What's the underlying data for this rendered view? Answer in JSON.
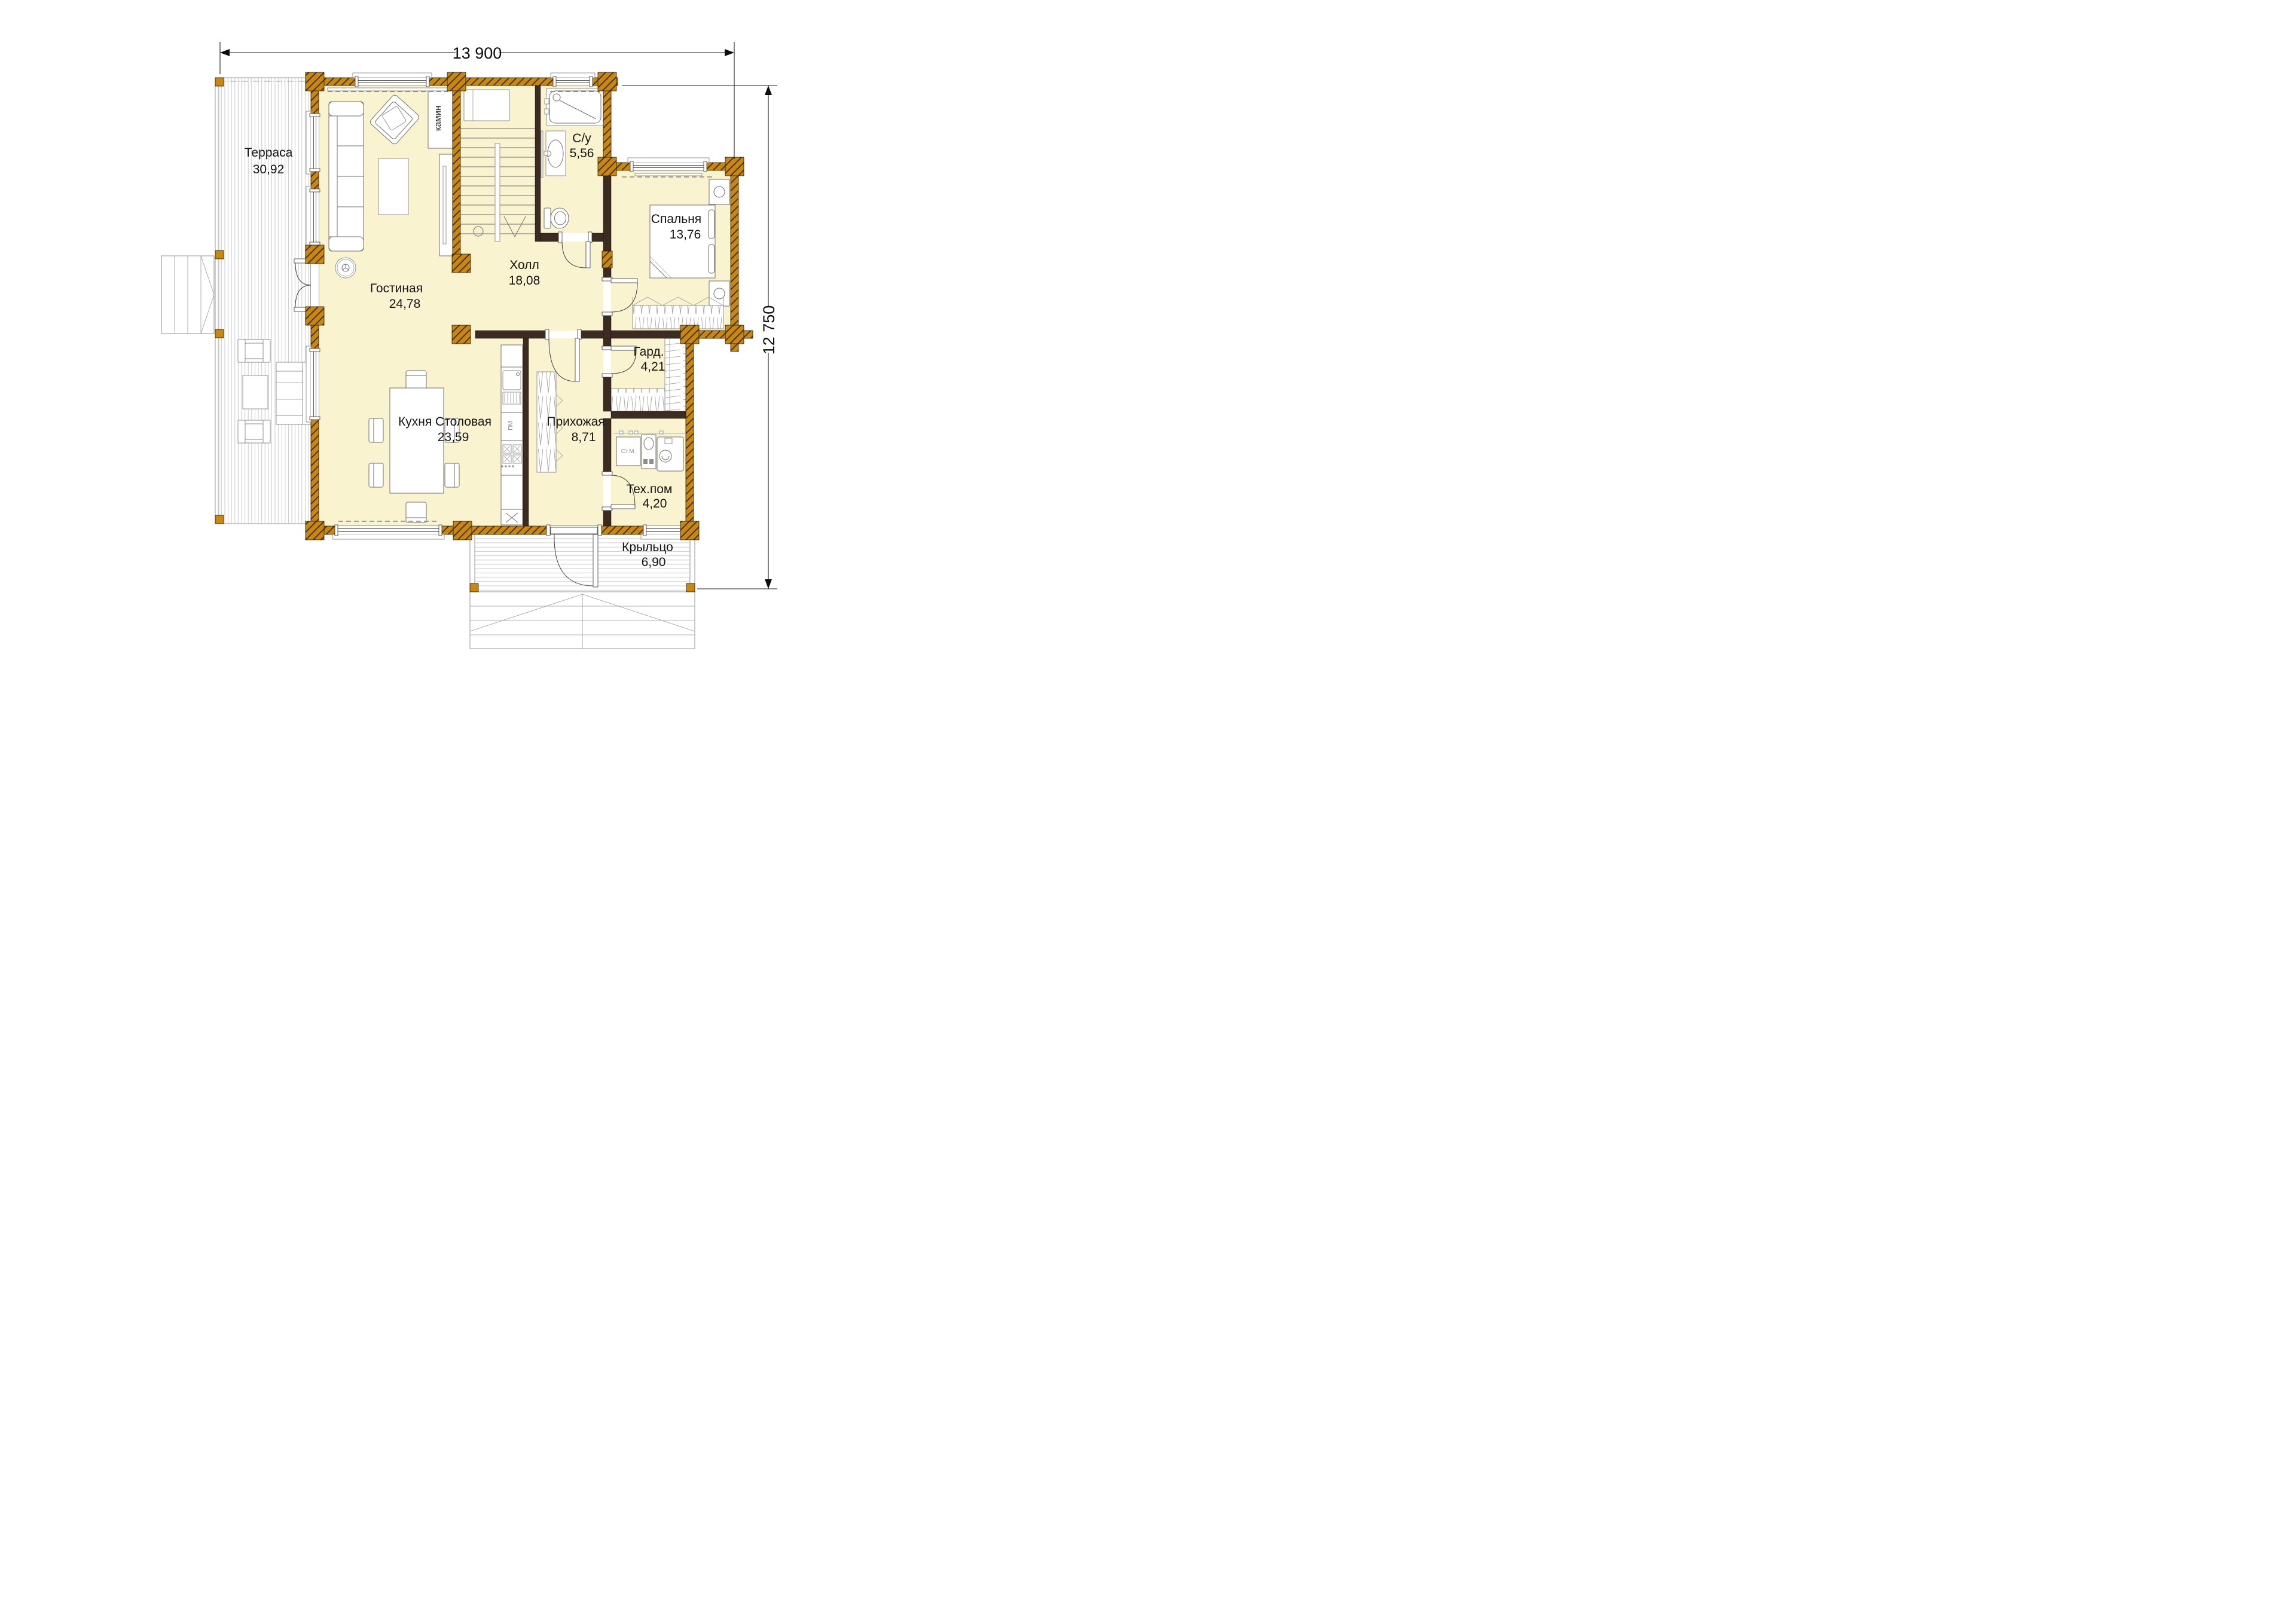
{
  "title": "Floor plan — first floor",
  "dimensions": {
    "width_label": "13 900",
    "height_label": "12 750"
  },
  "rooms": [
    {
      "id": "terrace",
      "name": "Терраса",
      "area": "30,92"
    },
    {
      "id": "living",
      "name": "Гостиная",
      "area": "24,78"
    },
    {
      "id": "hall",
      "name": "Холл",
      "area": "18,08"
    },
    {
      "id": "bathroom",
      "name": "С/у",
      "area": "5,56"
    },
    {
      "id": "bedroom",
      "name": "Спальня",
      "area": "13,76"
    },
    {
      "id": "wardrobe",
      "name": "Гард.",
      "area": "4,21"
    },
    {
      "id": "kitchen",
      "name": "Кухня Столовая",
      "area": "23,59"
    },
    {
      "id": "entry",
      "name": "Прихожая",
      "area": "8,71"
    },
    {
      "id": "tech",
      "name": "Тех.пом",
      "area": "4,20"
    },
    {
      "id": "porch",
      "name": "Крыльцо",
      "area": "6,90"
    }
  ],
  "fixtures": {
    "fireplace": "камин",
    "washing_machine": "Ст.М.",
    "dishwasher": "ПМ",
    "hood": "x"
  },
  "icons": [
    "sofa-icon",
    "armchair-icon",
    "coffee-table-icon",
    "tv-cabinet-icon",
    "fireplace-icon",
    "stairs-icon",
    "shower-icon",
    "sink-icon",
    "toilet-icon",
    "double-bed-icon",
    "nightstand-icon",
    "wardrobe-shelf-icon",
    "dining-table-icon",
    "chair-icon",
    "kitchen-counter-icon",
    "stove-icon",
    "washing-machine-icon",
    "boiler-icon",
    "entry-door-icon",
    "window-icon",
    "steps-icon"
  ],
  "colors": {
    "wall_log": "#C8870D",
    "wall_dark": "#3B2B20",
    "floor": "#FAF3CF",
    "outline": "#6f6f6f",
    "text": "#141414",
    "background": "#ffffff"
  }
}
